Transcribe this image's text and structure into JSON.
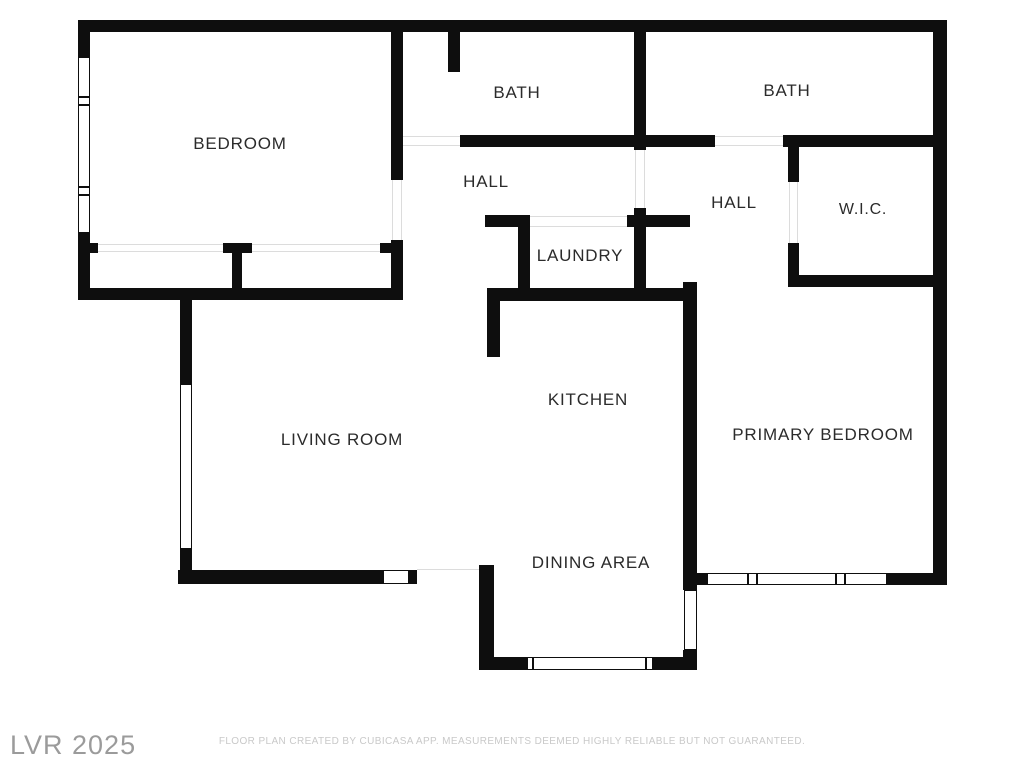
{
  "rooms": {
    "bedroom": {
      "label": "BEDROOM"
    },
    "bath_top": {
      "label": "BATH"
    },
    "bath_right": {
      "label": "BATH"
    },
    "hall_left": {
      "label": "HALL"
    },
    "hall_right": {
      "label": "HALL"
    },
    "wic": {
      "label": "W.I.C."
    },
    "laundry": {
      "label": "LAUNDRY"
    },
    "living_room": {
      "label": "LIVING ROOM"
    },
    "kitchen": {
      "label": "KITCHEN"
    },
    "primary_bedroom": {
      "label": "PRIMARY BEDROOM"
    },
    "dining_area": {
      "label": "DINING AREA"
    }
  },
  "watermark": {
    "text": "LVR 2025"
  },
  "footer": {
    "disclaimer": "FLOOR PLAN CREATED BY CUBICASA APP. MEASUREMENTS DEEMED HIGHLY RELIABLE BUT NOT GUARANTEED."
  },
  "colors": {
    "wall": "#0e0e0e",
    "label": "#2b2b2b",
    "watermark": "#9b9b9b",
    "disclaimer": "#c9c9c9",
    "opening_line": "#dcdcdc",
    "background": "#ffffff"
  }
}
